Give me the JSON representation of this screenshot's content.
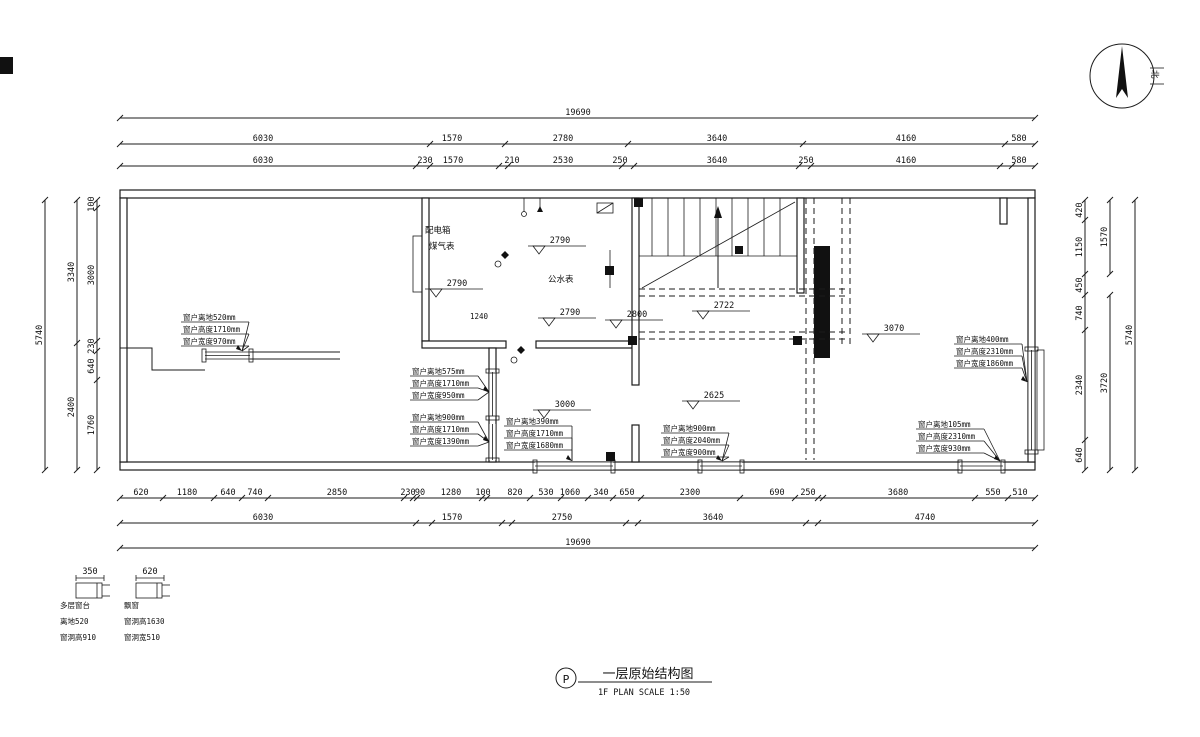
{
  "title_block": {
    "marker": "P",
    "name": "一层原始结构图",
    "scale": "1F PLAN   SCALE 1:50"
  },
  "north": {
    "label": "北"
  },
  "rooms": {
    "distribution_box": "配电箱",
    "gas_meter": "煤气表",
    "water_meter": "公水表",
    "door_height": "1240"
  },
  "dims": {
    "h": [
      {
        "y": 118,
        "x1": 120,
        "x2": 1035,
        "ticks": [
          120,
          1035
        ],
        "labels": [
          {
            "t": "19690",
            "x": 578
          }
        ]
      },
      {
        "y": 144,
        "x1": 120,
        "x2": 1035,
        "ticks": [
          120,
          430,
          505,
          628,
          803,
          1005,
          1035
        ],
        "labels": [
          {
            "t": "6030",
            "x": 263
          },
          {
            "t": "1570",
            "x": 452
          },
          {
            "t": "2780",
            "x": 563
          },
          {
            "t": "3640",
            "x": 717
          },
          {
            "t": "4160",
            "x": 906
          },
          {
            "t": "580",
            "x": 1019
          }
        ]
      },
      {
        "y": 166,
        "x1": 120,
        "x2": 1035,
        "ticks": [
          120,
          416,
          430,
          499,
          508,
          622,
          634,
          799,
          811,
          1000,
          1012,
          1035
        ],
        "labels": [
          {
            "t": "6030",
            "x": 263
          },
          {
            "t": "230",
            "x": 425
          },
          {
            "t": "1570",
            "x": 453
          },
          {
            "t": "210",
            "x": 512
          },
          {
            "t": "2530",
            "x": 563
          },
          {
            "t": "250",
            "x": 620
          },
          {
            "t": "3640",
            "x": 717
          },
          {
            "t": "250",
            "x": 806
          },
          {
            "t": "4160",
            "x": 906
          },
          {
            "t": "580",
            "x": 1019
          }
        ]
      },
      {
        "y": 498,
        "x1": 120,
        "x2": 1035,
        "ticks": [
          120,
          163,
          214,
          242,
          268,
          404,
          413,
          417,
          482,
          487,
          530,
          561,
          588,
          613,
          641,
          740,
          795,
          818,
          823,
          975,
          1008,
          1035
        ],
        "labels": [
          {
            "t": "620",
            "x": 141
          },
          {
            "t": "1180",
            "x": 187
          },
          {
            "t": "640",
            "x": 228
          },
          {
            "t": "740",
            "x": 255
          },
          {
            "t": "2850",
            "x": 337
          },
          {
            "t": "230",
            "x": 408
          },
          {
            "t": "90",
            "x": 420
          },
          {
            "t": "1280",
            "x": 451
          },
          {
            "t": "100",
            "x": 483
          },
          {
            "t": "820",
            "x": 515
          },
          {
            "t": "530",
            "x": 546
          },
          {
            "t": "1060",
            "x": 570
          },
          {
            "t": "340",
            "x": 601
          },
          {
            "t": "650",
            "x": 627
          },
          {
            "t": "2300",
            "x": 690
          },
          {
            "t": "690",
            "x": 777
          },
          {
            "t": "250",
            "x": 808
          },
          {
            "t": "3680",
            "x": 898
          },
          {
            "t": "550",
            "x": 993
          },
          {
            "t": "510",
            "x": 1020
          }
        ]
      },
      {
        "y": 523,
        "x1": 120,
        "x2": 1035,
        "ticks": [
          120,
          416,
          432,
          502,
          512,
          626,
          638,
          806,
          818,
          1035
        ],
        "labels": [
          {
            "t": "6030",
            "x": 263
          },
          {
            "t": "1570",
            "x": 452
          },
          {
            "t": "2750",
            "x": 562
          },
          {
            "t": "3640",
            "x": 713
          },
          {
            "t": "4740",
            "x": 925
          }
        ]
      },
      {
        "y": 548,
        "x1": 120,
        "x2": 1035,
        "ticks": [
          120,
          1035
        ],
        "labels": [
          {
            "t": "19690",
            "x": 578
          }
        ]
      }
    ],
    "v": [
      {
        "x": 45,
        "y1": 200,
        "y2": 470,
        "ticks": [
          200,
          470
        ],
        "labels": [
          {
            "t": "5740",
            "y": 335
          }
        ]
      },
      {
        "x": 77,
        "y1": 200,
        "y2": 470,
        "ticks": [
          200,
          343,
          470
        ],
        "labels": [
          {
            "t": "3340",
            "y": 272
          },
          {
            "t": "2400",
            "y": 407
          }
        ]
      },
      {
        "x": 97,
        "y1": 200,
        "y2": 470,
        "ticks": [
          200,
          208,
          341,
          351,
          380,
          470
        ],
        "labels": [
          {
            "t": "100",
            "y": 204
          },
          {
            "t": "3000",
            "y": 275
          },
          {
            "t": "230",
            "y": 346
          },
          {
            "t": "640",
            "y": 366
          },
          {
            "t": "1760",
            "y": 425
          }
        ]
      },
      {
        "x": 1085,
        "y1": 200,
        "y2": 470,
        "ticks": [
          200,
          220,
          274,
          295,
          330,
          440,
          470
        ],
        "labels": [
          {
            "t": "420",
            "y": 210
          },
          {
            "t": "1150",
            "y": 247
          },
          {
            "t": "450",
            "y": 285
          },
          {
            "t": "740",
            "y": 313
          },
          {
            "t": "2340",
            "y": 385
          },
          {
            "t": "640",
            "y": 455
          }
        ]
      },
      {
        "x": 1110,
        "y1": 200,
        "y2": 274,
        "ticks": [
          200,
          274
        ],
        "labels": [
          {
            "t": "1570",
            "y": 237
          }
        ]
      },
      {
        "x": 1110,
        "y1": 295,
        "y2": 470,
        "ticks": [
          295,
          470
        ],
        "labels": [
          {
            "t": "3720",
            "y": 383
          }
        ]
      },
      {
        "x": 1135,
        "y1": 200,
        "y2": 470,
        "ticks": [
          200,
          470
        ],
        "labels": [
          {
            "t": "5740",
            "y": 335
          }
        ]
      }
    ]
  },
  "annotations": [
    {
      "x": 183,
      "y": 320,
      "tx": 242,
      "ty": 351,
      "lines": [
        "窗户离地520mm",
        "窗户高度1710mm",
        "窗户宽度970mm"
      ]
    },
    {
      "x": 412,
      "y": 374,
      "tx": 489,
      "ty": 392,
      "lines": [
        "窗户离地575mm",
        "窗户高度1710mm",
        "窗户宽度950mm"
      ]
    },
    {
      "x": 412,
      "y": 420,
      "tx": 489,
      "ty": 442,
      "lines": [
        "窗户离地900mm",
        "窗户高度1710mm",
        "窗户宽度1390mm"
      ]
    },
    {
      "x": 506,
      "y": 424,
      "tx": 572,
      "ty": 461,
      "lines": [
        "窗户离地390mm",
        "窗户高度1710mm",
        "窗户宽度1680mm"
      ]
    },
    {
      "x": 663,
      "y": 431,
      "tx": 722,
      "ty": 461,
      "lines": [
        "窗户离地900mm",
        "窗户高度2040mm",
        "窗户宽度900mm"
      ]
    },
    {
      "x": 956,
      "y": 342,
      "tx": 1027,
      "ty": 382,
      "lines": [
        "窗户离地400mm",
        "窗户高度2310mm",
        "窗户宽度1860mm"
      ]
    },
    {
      "x": 918,
      "y": 427,
      "tx": 1000,
      "ty": 461,
      "lines": [
        "窗户离地105mm",
        "窗户高度2310mm",
        "窗户宽度930mm"
      ]
    }
  ],
  "elevations": [
    {
      "t": "2790",
      "x": 528,
      "y": 238
    },
    {
      "t": "2790",
      "x": 425,
      "y": 281
    },
    {
      "t": "2790",
      "x": 538,
      "y": 310
    },
    {
      "t": "2800",
      "x": 605,
      "y": 312
    },
    {
      "t": "2722",
      "x": 692,
      "y": 303
    },
    {
      "t": "2625",
      "x": 682,
      "y": 393
    },
    {
      "t": "3070",
      "x": 862,
      "y": 326
    },
    {
      "t": "3000",
      "x": 533,
      "y": 402
    }
  ],
  "legend": {
    "a": {
      "dim": "350",
      "lines": [
        "多层窗台",
        "离地520",
        "窗洞高910"
      ]
    },
    "b": {
      "dim": "620",
      "lines": [
        "飘窗",
        "窗洞高1630",
        "窗洞宽510"
      ]
    }
  }
}
